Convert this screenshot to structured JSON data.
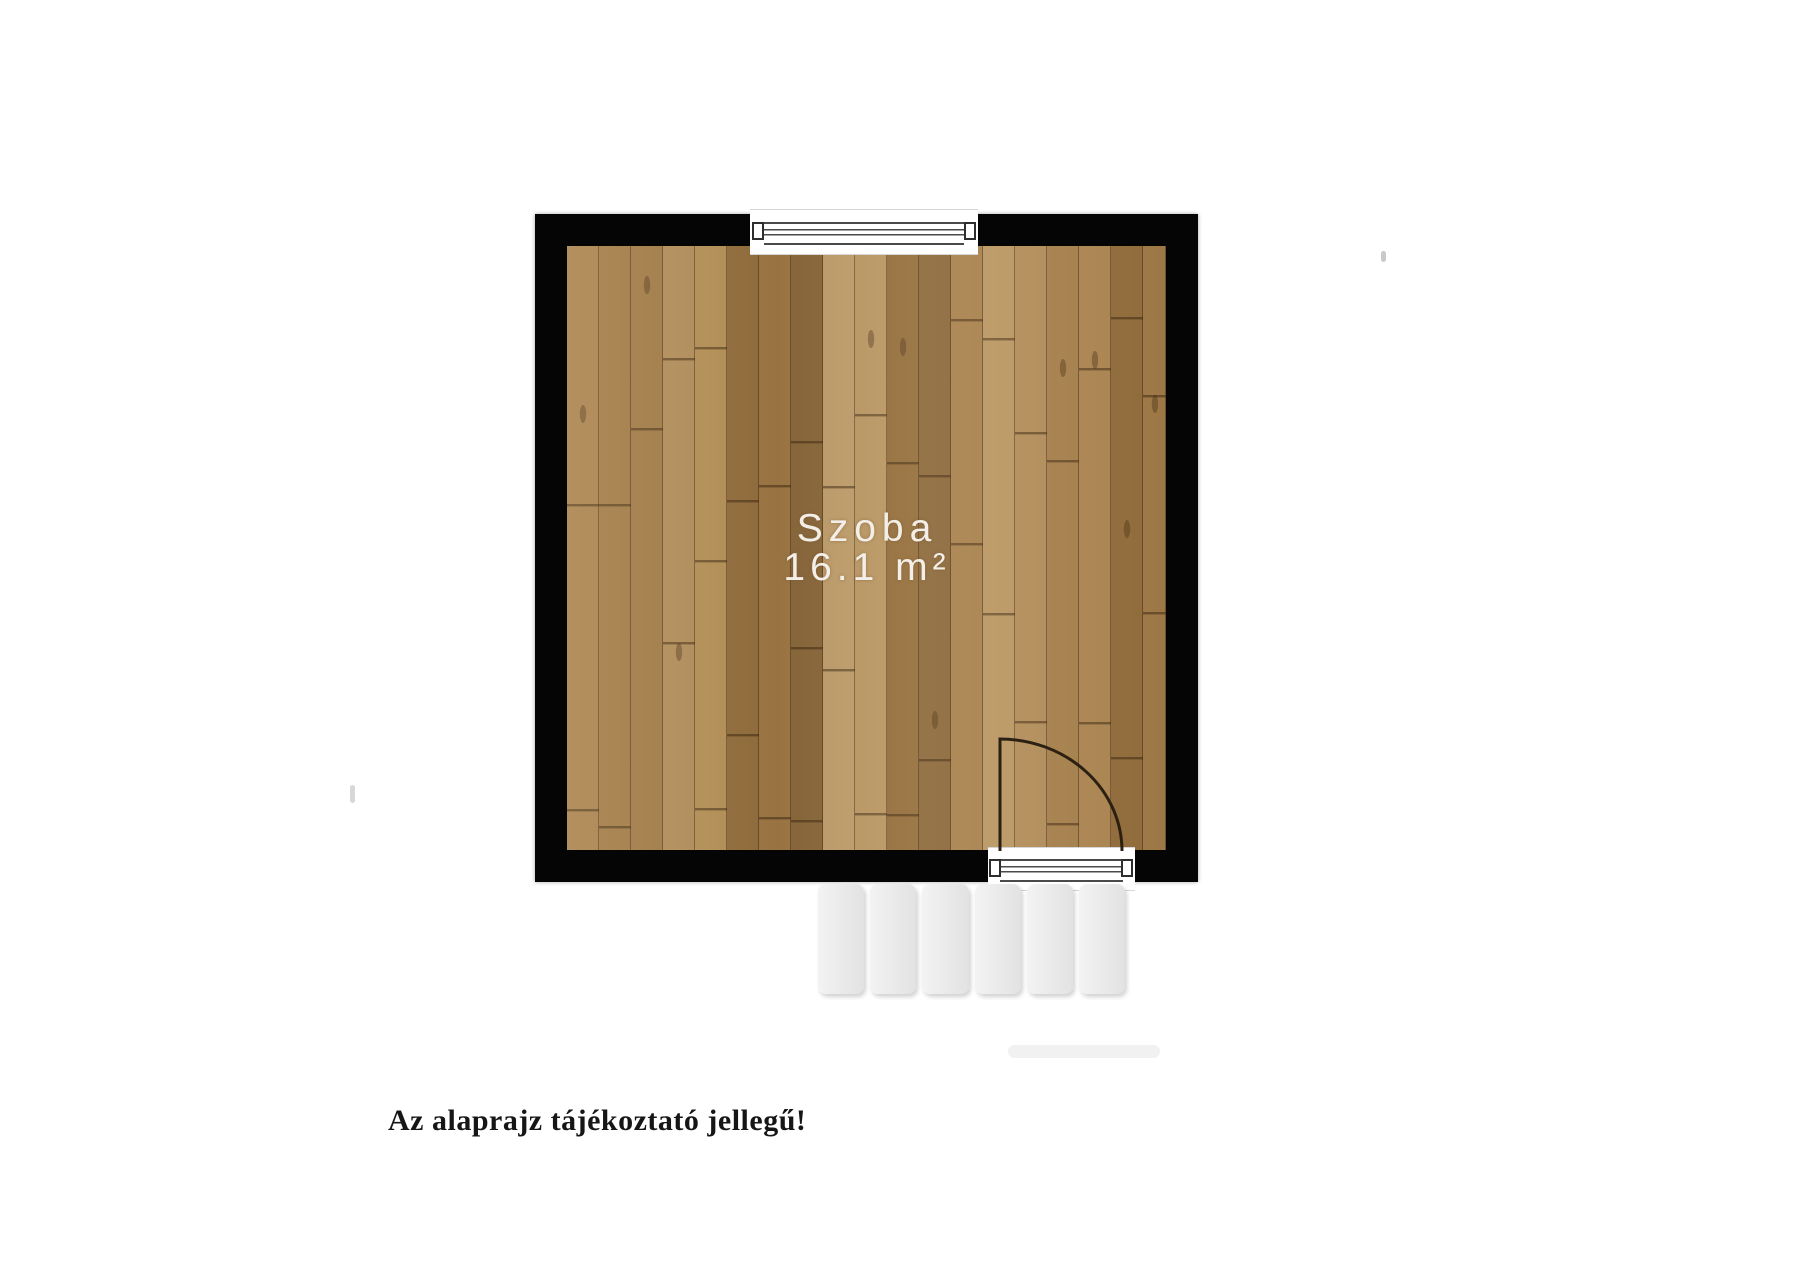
{
  "floorplan": {
    "room": {
      "name": "Szoba",
      "area": "16.1 m²"
    },
    "disclaimer": "Az alaprajz tájékoztató jellegű!",
    "stairs": {
      "count": 6
    },
    "colors": {
      "background": "#ffffff",
      "wall": "#050505",
      "floor_light": "#c2a06d",
      "floor_dark": "#8d6a3d",
      "room_label_text": "#f3efe8",
      "fixture_line": "#4a4a4a",
      "door_arc": "#2b2012",
      "step_fill": "#ececec",
      "disclaimer_text": "#161616"
    }
  }
}
